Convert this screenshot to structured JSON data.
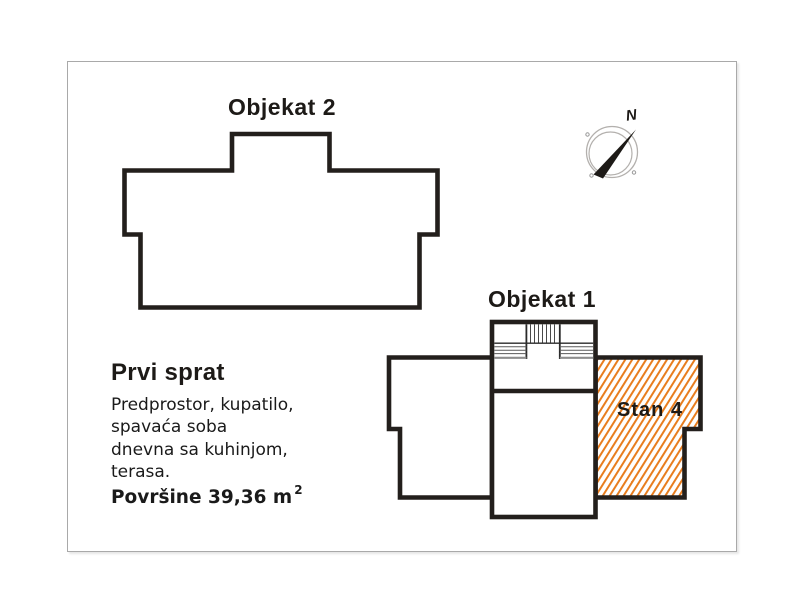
{
  "labels": {
    "objekat2": "Objekat 2",
    "objekat1": "Objekat 1",
    "stan4": "Stan 4"
  },
  "info": {
    "floor_title": "Prvi sprat",
    "rooms_lines": [
      "Predprostor, kupatilo,",
      "spavaća soba",
      "dnevna sa kuhinjom,",
      "terasa."
    ],
    "area_text": "Površine 39,36 m",
    "area_sup": "2"
  },
  "compass": {
    "north_label": "N"
  },
  "colors": {
    "wall": "#231f1c",
    "hatch_orange": "#e87d1e",
    "text": "#1d1a17",
    "panel_border": "#a9a9a9",
    "compass_circle": "#b3b0ad"
  }
}
